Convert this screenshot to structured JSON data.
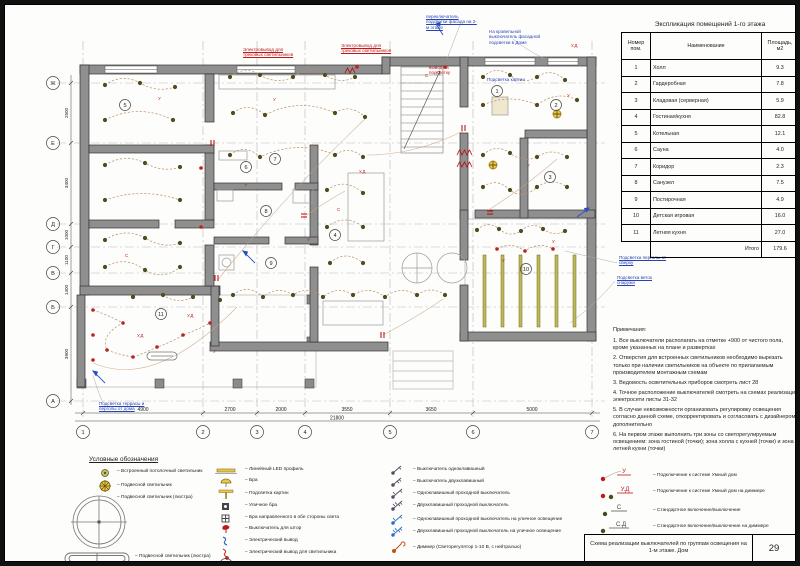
{
  "explication": {
    "title": "Экспликация помещений 1-го этажа",
    "col_num": "Номер пом.",
    "col_name": "Наименование",
    "col_area": "Площадь, м2",
    "rows": [
      {
        "n": "1",
        "name": "Холл",
        "area": "9.3"
      },
      {
        "n": "2",
        "name": "Гардеробная",
        "area": "7.8"
      },
      {
        "n": "3",
        "name": "Кладовая (серверная)",
        "area": "5.9"
      },
      {
        "n": "4",
        "name": "Гостиная/кухня",
        "area": "82.8"
      },
      {
        "n": "5",
        "name": "Котельная",
        "area": "12.1"
      },
      {
        "n": "6",
        "name": "Сауна",
        "area": "4.0"
      },
      {
        "n": "7",
        "name": "Коридор",
        "area": "2.3"
      },
      {
        "n": "8",
        "name": "Санузел",
        "area": "7.5"
      },
      {
        "n": "9",
        "name": "Постирочная",
        "area": "4.9"
      },
      {
        "n": "10",
        "name": "Детская игровая",
        "area": "16.0"
      },
      {
        "n": "11",
        "name": "Летняя кухня",
        "area": "27.0"
      }
    ],
    "total_label": "Итого",
    "total": "179.6"
  },
  "notes": {
    "title": "Примечания:",
    "items": [
      "1.  Все выключатели располагать на отметке +900 от чистого пола, кроме указанных на плане и развертках",
      "2.  Отверстия для встроенных светильников необходимо вырезать только при наличии светильников на объекте по прилагаемым производителем монтажным схемам",
      "3.  Ведомость осветительных приборов смотреть лист 28",
      "4.  Точное расположение выключателей смотреть на схемах реализации электросети листы 31-32",
      "5.  В случае невозможности организовать регулировку освещения согласно данной схеме, откорректировать и согласовать с дизайнером дополнительно",
      "6.  На первом этаже выполнить три зоны со светорегулируемым освещением: зона гостиной (точки); зона холла с кухней (точки) и зона летней кухни (точки)"
    ]
  },
  "legend": {
    "heading": "Условные обозначения",
    "col1": [
      "– Встроенный потолочный светильник",
      "– Подвесной светильник",
      "– Подвесной светильник (люстра)",
      "– Подвесной светильник (люстра)"
    ],
    "col2": [
      "– Линейный LED профиль",
      "– Бра",
      "– Подсветка картин",
      "– Уличное бра",
      "– Бра направленного в обе стороны света",
      "– Выключатель для штор",
      "– Электрический вывод",
      "– Электрический вывод для светильника",
      "– Номер помещения по экспликации"
    ],
    "col2_bubble": "10",
    "col3": [
      "– Выключатель одноклавишный",
      "– Выключатель двухклавишный",
      "– Одноклавишный проходной выключатель",
      "– Двухклавишный проходной выключатель",
      "– Одноклавишный проходной выключатель на уличное освещение",
      "– Двухклавишный проходной выключатель на уличное освещение",
      "– Диммер (Светорегулятор 1-10 В, с нейтралью)"
    ],
    "col4": [
      {
        "sym": "У",
        "label": "– Подключение к системе Умный дом"
      },
      {
        "sym": "У.Д",
        "label": "– Подключение к системе Умный дом на диммере"
      },
      {
        "sym": "С",
        "label": "– Стандартное включение/выключение"
      },
      {
        "sym": "С.Д",
        "label": "– Стандартное включение/выключение на диммере"
      }
    ]
  },
  "titleblock": {
    "title": "Схема реализации выключателей по группам освещения на 1-м этаже. Дом",
    "sheet_no": "29"
  },
  "plan": {
    "axes_bottom": [
      "1",
      "2",
      "3",
      "4",
      "5",
      "6",
      "7"
    ],
    "axes_left": [
      "Ж",
      "Е",
      "Д",
      "Г",
      "В",
      "Б",
      "А"
    ],
    "dims_bottom": [
      "4900",
      "2700",
      "2000",
      "3550",
      "3650",
      "5000"
    ],
    "dims_total": "21800",
    "dims_left": [
      "2500",
      "3400",
      "1000",
      "1100",
      "1400",
      "3900"
    ],
    "rooms": [
      {
        "n": "1"
      },
      {
        "n": "2"
      },
      {
        "n": "3"
      },
      {
        "n": "4"
      },
      {
        "n": "5"
      },
      {
        "n": "6"
      },
      {
        "n": "7"
      },
      {
        "n": "8"
      },
      {
        "n": "9"
      },
      {
        "n": "10"
      },
      {
        "n": "11"
      }
    ],
    "annotations": {
      "top_blue_1": "переключатель подсветки фасада на 2-м этаже",
      "top_blue_2": "На кровельной выключатель фасадной подсветки в Доме",
      "mid_blue_1": "Подсветка картин",
      "red_1": "Электровывод для трековых светильников",
      "red_2": "Электровывод для трековых светильников",
      "red_3": "вывод на подсветку",
      "right_blue_1": "Подсветка перголы от сверху",
      "right_blue_2": "Подсветка веток снаружи",
      "bottom_blue_1": "Подсветка террасы и перголы от дома"
    },
    "markers": [
      {
        "x": 302,
        "y": 236,
        "t": "У"
      },
      {
        "x": 332,
        "y": 206,
        "t": "С"
      },
      {
        "x": 354,
        "y": 168,
        "t": "У.Д"
      },
      {
        "x": 240,
        "y": 182,
        "t": "Г"
      },
      {
        "x": 522,
        "y": 162,
        "t": "У"
      },
      {
        "x": 547,
        "y": 238,
        "t": "У"
      },
      {
        "x": 562,
        "y": 92,
        "t": "У"
      },
      {
        "x": 182,
        "y": 312,
        "t": "У.Д"
      },
      {
        "x": 208,
        "y": 348,
        "t": "У"
      },
      {
        "x": 132,
        "y": 332,
        "t": "У.Д"
      },
      {
        "x": 497,
        "y": 257,
        "t": "У"
      },
      {
        "x": 420,
        "y": 72,
        "t": "С"
      },
      {
        "x": 268,
        "y": 96,
        "t": "У"
      },
      {
        "x": 566,
        "y": 42,
        "t": "У.Д"
      },
      {
        "x": 120,
        "y": 252,
        "t": "С"
      },
      {
        "x": 153,
        "y": 95,
        "t": "У"
      }
    ]
  }
}
